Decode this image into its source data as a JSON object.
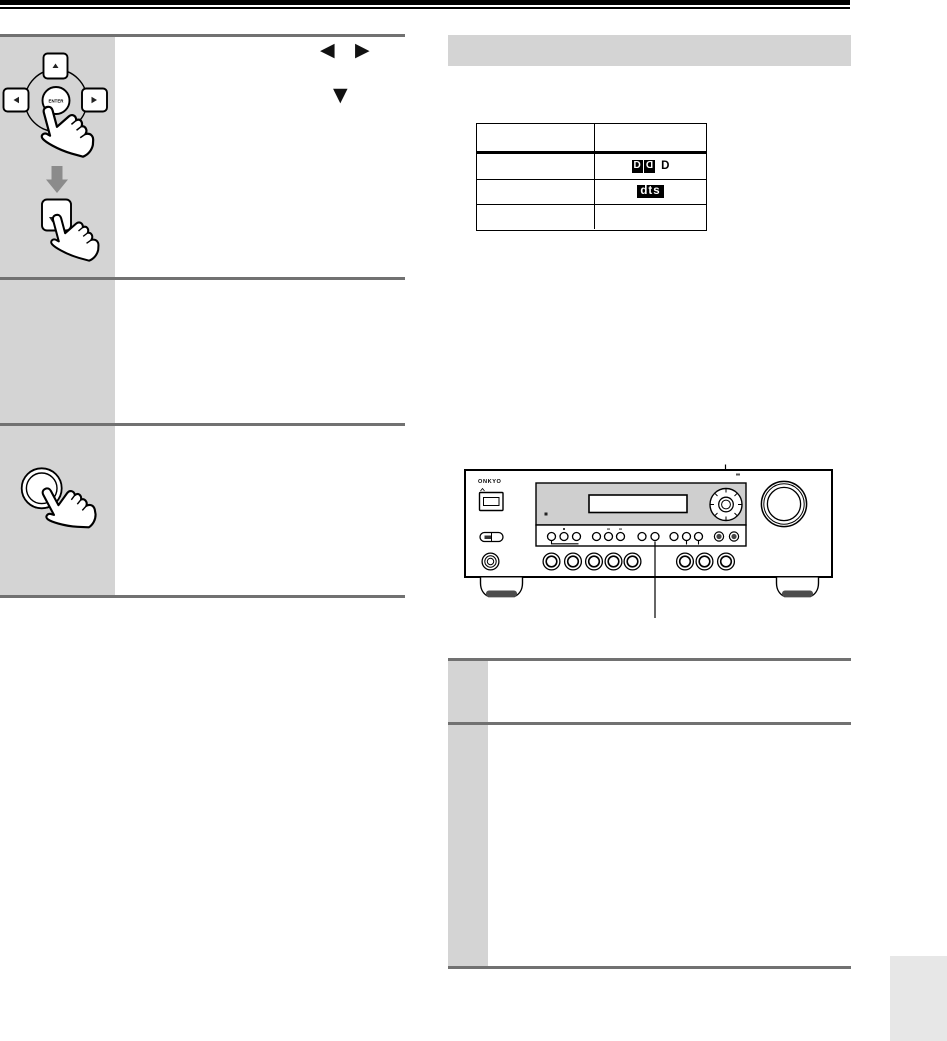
{
  "colors": {
    "header_bar": "#000000",
    "panel_gray": "#d4d4d4",
    "rule_gray": "#717171",
    "arrow_gray": "#8b8b8b",
    "page_tab_gray": "#e7e7e7",
    "receiver_panel_gray": "#cfcfcf"
  },
  "glyphs": {
    "left_arrow": "◀",
    "right_arrow": "▶",
    "down_arrow": "▼"
  },
  "remote": {
    "enter_label": "ENTER"
  },
  "receiver": {
    "brand": "ONKYO"
  },
  "format_table": {
    "dolby_letter": "D",
    "dolby_suffix": "D",
    "dts_text": "dts"
  }
}
